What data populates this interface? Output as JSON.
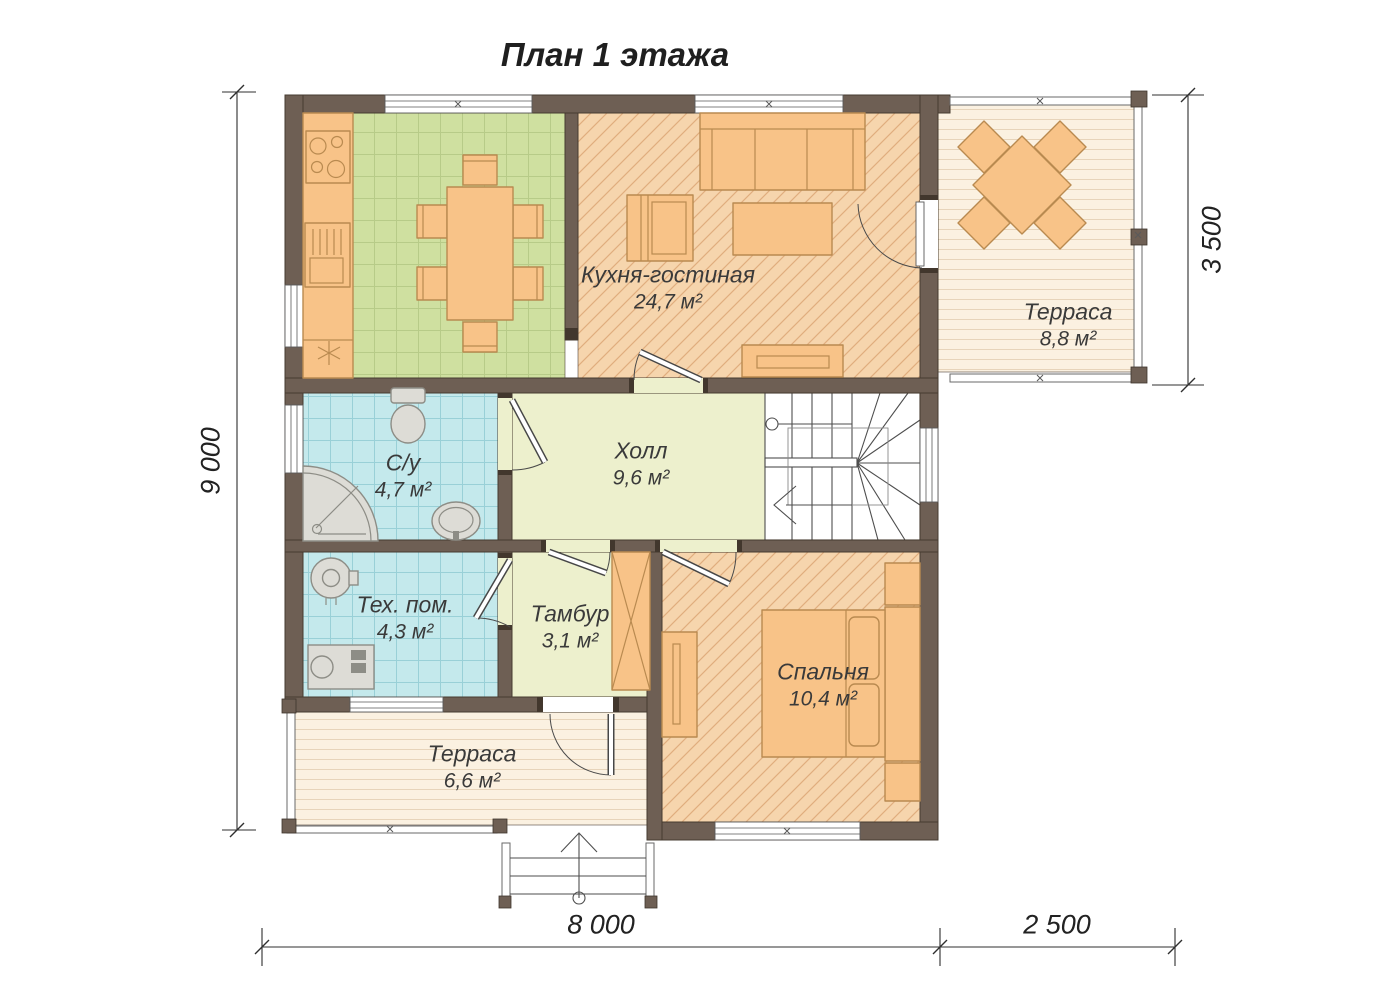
{
  "title": "План 1 этажа",
  "rooms": {
    "kitchen_living": {
      "name": "Кухня-гостиная",
      "area": "24,7 м²"
    },
    "terrace_top": {
      "name": "Терраса",
      "area": "8,8 м²"
    },
    "bathroom": {
      "name": "С/у",
      "area": "4,7 м²"
    },
    "hall": {
      "name": "Холл",
      "area": "9,6 м²"
    },
    "tech_room": {
      "name": "Тех. пом.",
      "area": "4,3 м²"
    },
    "vestibule": {
      "name": "Тамбур",
      "area": "3,1 м²"
    },
    "bedroom": {
      "name": "Спальня",
      "area": "10,4 м²"
    },
    "terrace_bottom": {
      "name": "Терраса",
      "area": "6,6 м²"
    }
  },
  "dimensions": {
    "height_total": "9 000",
    "terrace_height": "3 500",
    "width_main": "8 000",
    "width_terrace": "2 500"
  },
  "colors": {
    "wall": "#6e5f54",
    "kitchen_floor": "#cfe0a0",
    "kitchen_grid": "#b7cb88",
    "tile_floor": "#c4e9ec",
    "tile_grid": "#99d0d7",
    "wood_floor": "#f6d5ad",
    "wood_hatch": "#e0ae7e",
    "pale_floor": "#edf0cd",
    "deck_floor": "#fbf1e1",
    "deck_line": "#e7d4ba",
    "furniture": "#f8c388",
    "furniture_stroke": "#b98a50",
    "fixture": "#dddcd6",
    "fixture_stroke": "#8d8d86",
    "text": "#3a3a3a"
  }
}
